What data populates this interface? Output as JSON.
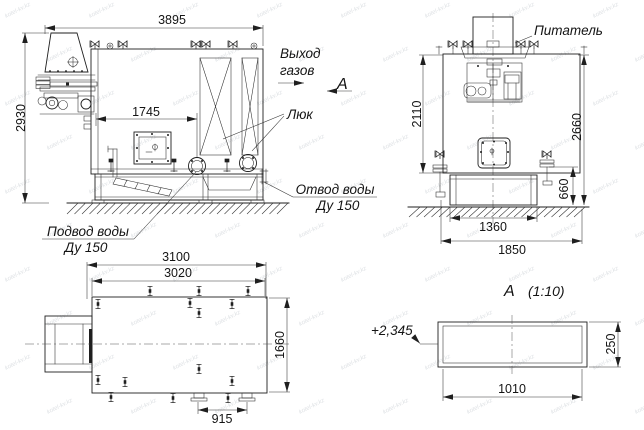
{
  "drawing": {
    "watermark": "kotel-kv.kz",
    "labels": {
      "gas_outlet_line1": "Выход",
      "gas_outlet_line2": "газов",
      "view_arrow_letter": "А",
      "hatch": "Люк",
      "water_outlet_line1": "Отвод воды",
      "water_outlet_line2": "Ду 150",
      "water_inlet_line1": "Подвод воды",
      "water_inlet_line2": "Ду 150",
      "feeder": "Питатель",
      "detail_title_letter": "А",
      "detail_title_scale": "(1:10)",
      "elevation_mark": "+2,345"
    },
    "dimensions": {
      "side": {
        "overall_width": "3895",
        "overall_height": "2930",
        "front_to_flange": "1745"
      },
      "front": {
        "body_height": "2110",
        "total_height": "2660",
        "base_height": "660",
        "base_width": "1360",
        "overall_width": "1850"
      },
      "plan": {
        "overall_length": "3100",
        "body_length": "3020",
        "overall_depth": "1660",
        "stub_spacing": "915"
      },
      "detail_a": {
        "length": "1010",
        "height": "250"
      }
    }
  }
}
